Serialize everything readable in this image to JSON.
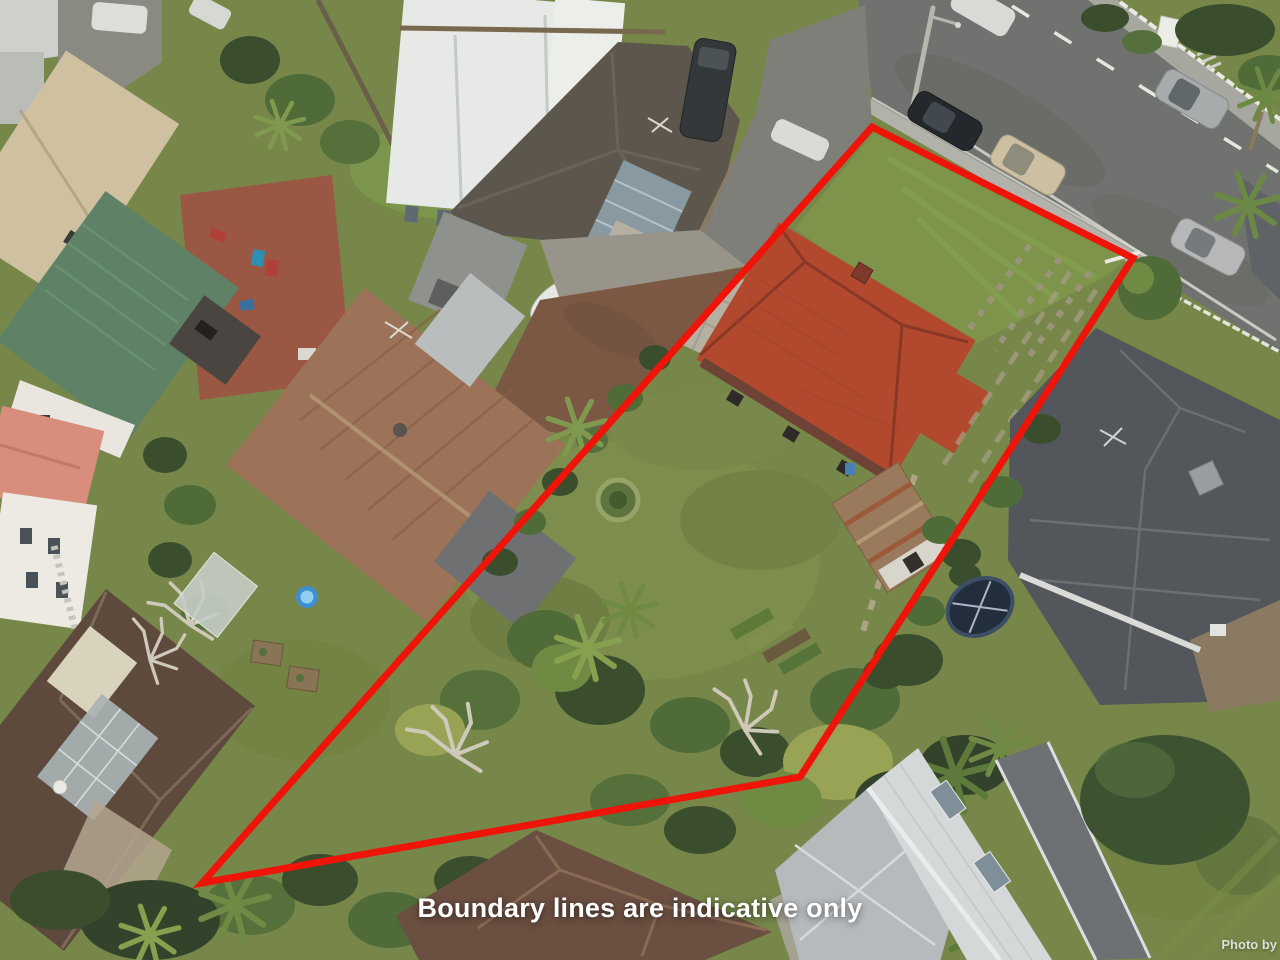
{
  "overlay": {
    "disclaimer": "Boundary lines are indicative only",
    "watermark": "Photo by"
  },
  "boundary": {
    "color": "#ee1409",
    "width": 7,
    "points": "872,127 1133,258 800,777 202,883"
  },
  "palette": {
    "grass": "#77874a",
    "road": "#6f726e",
    "subject_roof": "#b2492f",
    "subject_ridge": "#8a3826",
    "big_house_roof": "#5d564c",
    "rusty_roof": "#9c7258",
    "green_roof": "#5f8266",
    "charcoal_roof": "#53565a",
    "bottom_left_roof": "#5e4a3c",
    "bottom_center_roof": "#6b4f41",
    "white_metal_roof": "#d5d8d9",
    "cream_roof": "#cfc0a0",
    "coral_roof": "#d98d7c",
    "driveway_brick": "#7b5844",
    "front_lawn": "#7d944a"
  }
}
